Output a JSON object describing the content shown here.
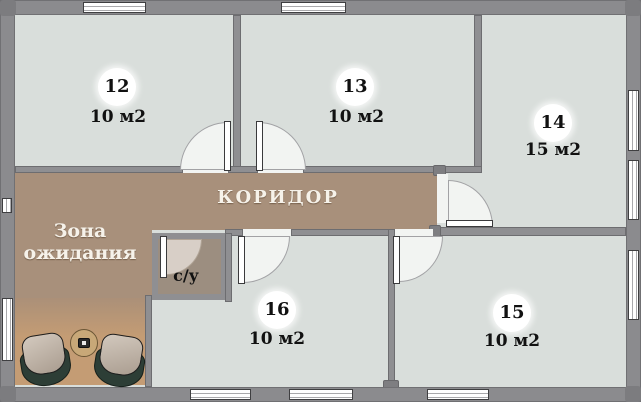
{
  "plan": {
    "title": "office-floor-plan",
    "rooms": [
      {
        "number": "12",
        "area": "10 м2"
      },
      {
        "number": "13",
        "area": "10 м2"
      },
      {
        "number": "14",
        "area": "15 м2"
      },
      {
        "number": "15",
        "area": "10 м2"
      },
      {
        "number": "16",
        "area": "10 м2"
      }
    ],
    "corridor_label": "КОРИДОР",
    "waiting_area": {
      "line1": "Зона",
      "line2": "ожидания"
    },
    "bathroom_label": "с/у",
    "colors": {
      "room_fill": "#d9dedb",
      "wall": "#8f8f92",
      "corridor_brown": "#a8907b",
      "waiting_rug": "#c49c74",
      "bathroom_fill": "#9c8e80",
      "chair_shell": "#2d3e36",
      "chair_cushion": "#b9ac9f",
      "table": "#c8a878"
    }
  }
}
